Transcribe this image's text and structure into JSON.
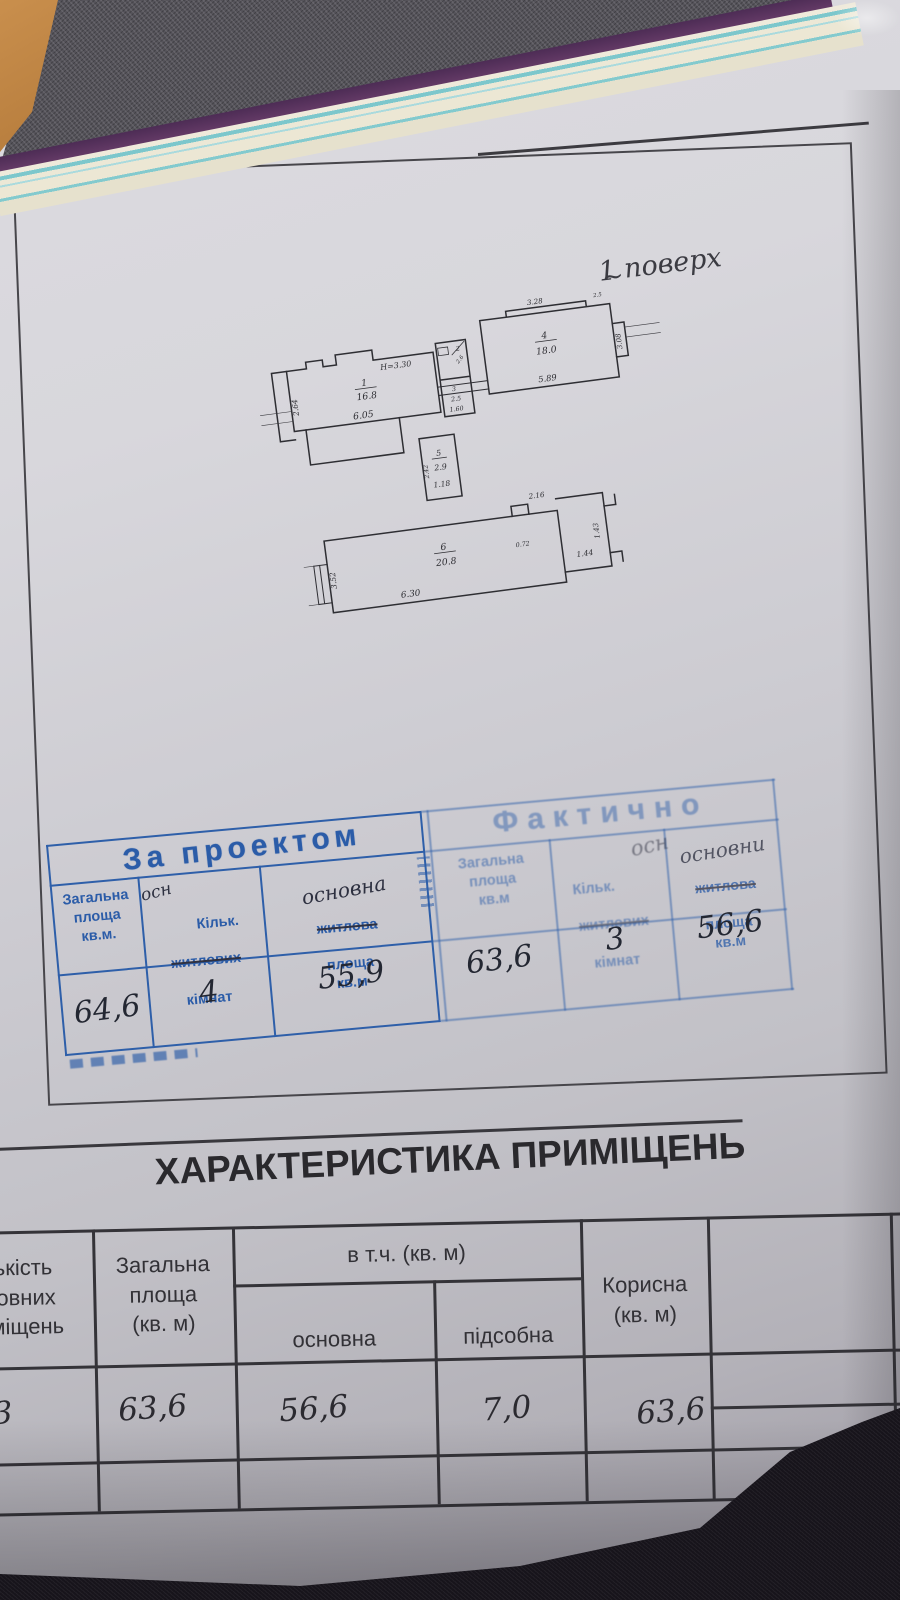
{
  "title": {
    "line1": "ІІ. ПЛАН ПРИМІЩЕНЬ",
    "line2": "М 1:200"
  },
  "plan": {
    "floor_label": "1 поверх",
    "floor_tilde": "~",
    "room1": {
      "num": "1",
      "area": "16.8",
      "width": "6.05",
      "note": "Н=3.30",
      "side": "2.64"
    },
    "room2": {
      "num": "2",
      "dim": "2.6"
    },
    "room3": {
      "num": "3",
      "area": "2.5",
      "width": "1.60"
    },
    "room4": {
      "num": "4",
      "area": "18.0",
      "width": "5.89",
      "top": "3.28",
      "side": "3.08",
      "corner": "2.5"
    },
    "room5": {
      "num": "5",
      "area": "2.9",
      "width": "1.18",
      "side": "2.42"
    },
    "room6": {
      "num": "6",
      "area": "20.8",
      "width": "6.30",
      "side": "3.52"
    },
    "nook": {
      "top": "2.16",
      "inner": "0.72",
      "width": "1.44",
      "side": "1.43"
    }
  },
  "stamp_table": {
    "left_title": "За проектом",
    "right_title": "Фактично",
    "c1": "Загальна\nплоща\nкв.м.",
    "c2_hand": "осн",
    "c2_l1": "Кільк.",
    "c2_struck": "житлових",
    "c2_l3": "кімнат",
    "c3_hand": "основна",
    "c3_struck": "житлова",
    "c3_rest": "площа\nкв.м",
    "c4": "Загальна\nплоща\nкв.м",
    "c5_l1": "Кільк.",
    "c5_hand": "осн",
    "c5_struck": "житлових",
    "c5_l3": "кімнат",
    "c6_hand": "основни",
    "c6_struck": "житлова",
    "c6_rest": "площа\nкв.м",
    "values": [
      "64,6",
      "4",
      "55,9",
      "63,6",
      "3",
      "56,6"
    ]
  },
  "char_table": {
    "title": "ХАРАКТЕРИСТИКА ПРИМІЩЕНЬ",
    "col_count": "Кількість\nосновних\nприміщень",
    "col_total": "Загальна\nплоща\n(кв. м)",
    "col_incl": "в т.ч. (кв. м)",
    "col_main": "основна",
    "col_aux": "підсобна",
    "col_useful": "Корисна\n(кв. м)",
    "values": {
      "count": "3",
      "total": "63,6",
      "main": "56,6",
      "aux": "7,0",
      "useful": "63,6"
    }
  }
}
